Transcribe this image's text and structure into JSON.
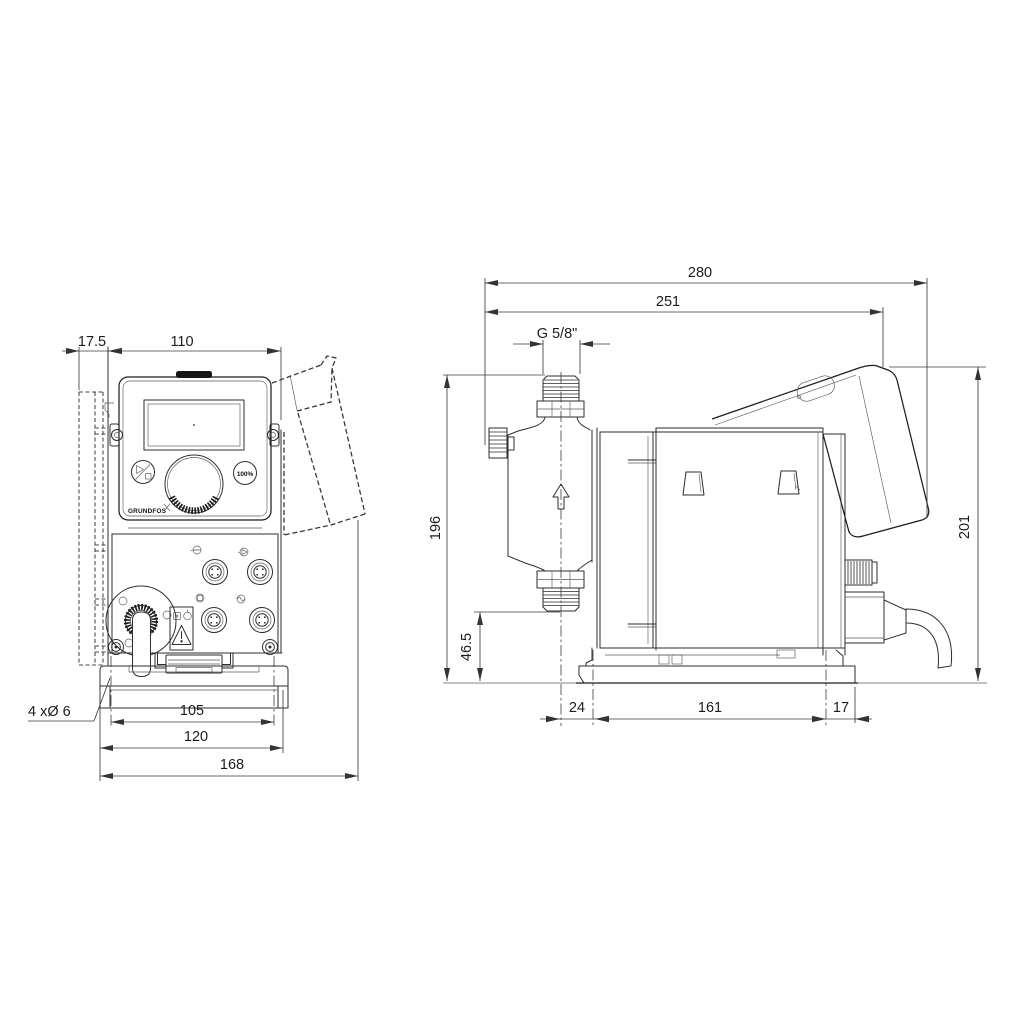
{
  "front_view": {
    "dims": {
      "wall_offset": "17.5",
      "width": "110",
      "hole_spacing": "105",
      "base_width": "120",
      "overall_width": "168"
    },
    "mounting_holes_label": "4 xØ 6",
    "panel": {
      "button_100_label": "100%",
      "brand_logo": "GRUNDFOS"
    }
  },
  "side_view": {
    "dims": {
      "overall_depth": "280",
      "depth_to_panel": "251",
      "height": "196",
      "connection_height": "46.5",
      "front_offset": "24",
      "foot_spacing": "161",
      "rear_offset": "17",
      "overall_height": "201"
    },
    "thread_label": "G 5/8\""
  }
}
